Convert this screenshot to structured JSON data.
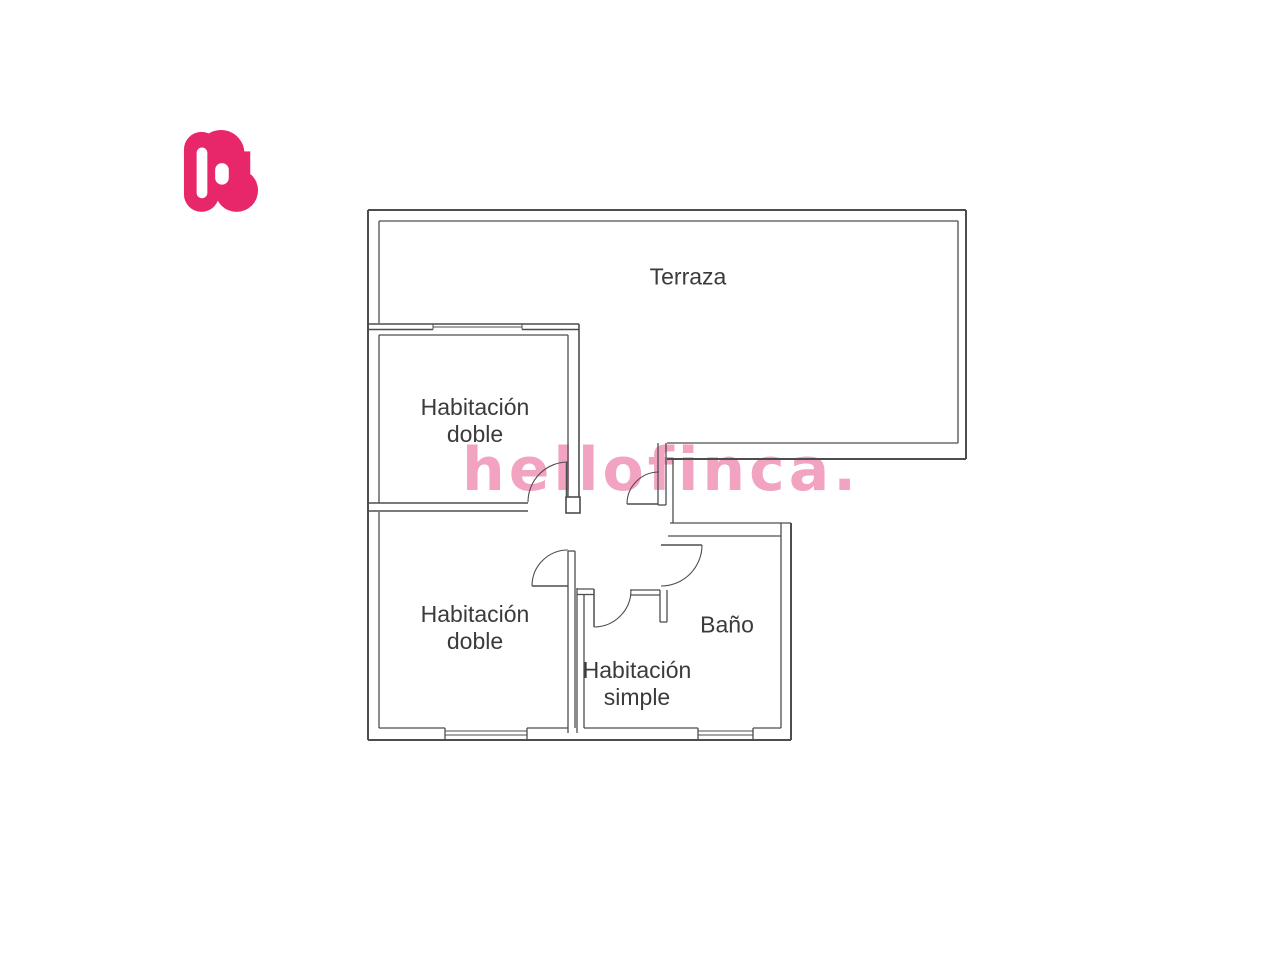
{
  "logo": {
    "letter": "h",
    "color": "#e8276b"
  },
  "watermark": {
    "text": "hellofinca.",
    "color": "#f2a3c1"
  },
  "floorplan": {
    "wall_color": "#4d4d4d",
    "label_color": "#3b3b3b",
    "rooms": [
      {
        "id": "terraza",
        "label": "Terraza"
      },
      {
        "id": "habitacion-doble-1",
        "label": "Habitación doble"
      },
      {
        "id": "habitacion-doble-2",
        "label": "Habitación doble"
      },
      {
        "id": "habitacion-simple",
        "label": "Habitación simple"
      },
      {
        "id": "bano",
        "label": "Baño"
      }
    ]
  }
}
